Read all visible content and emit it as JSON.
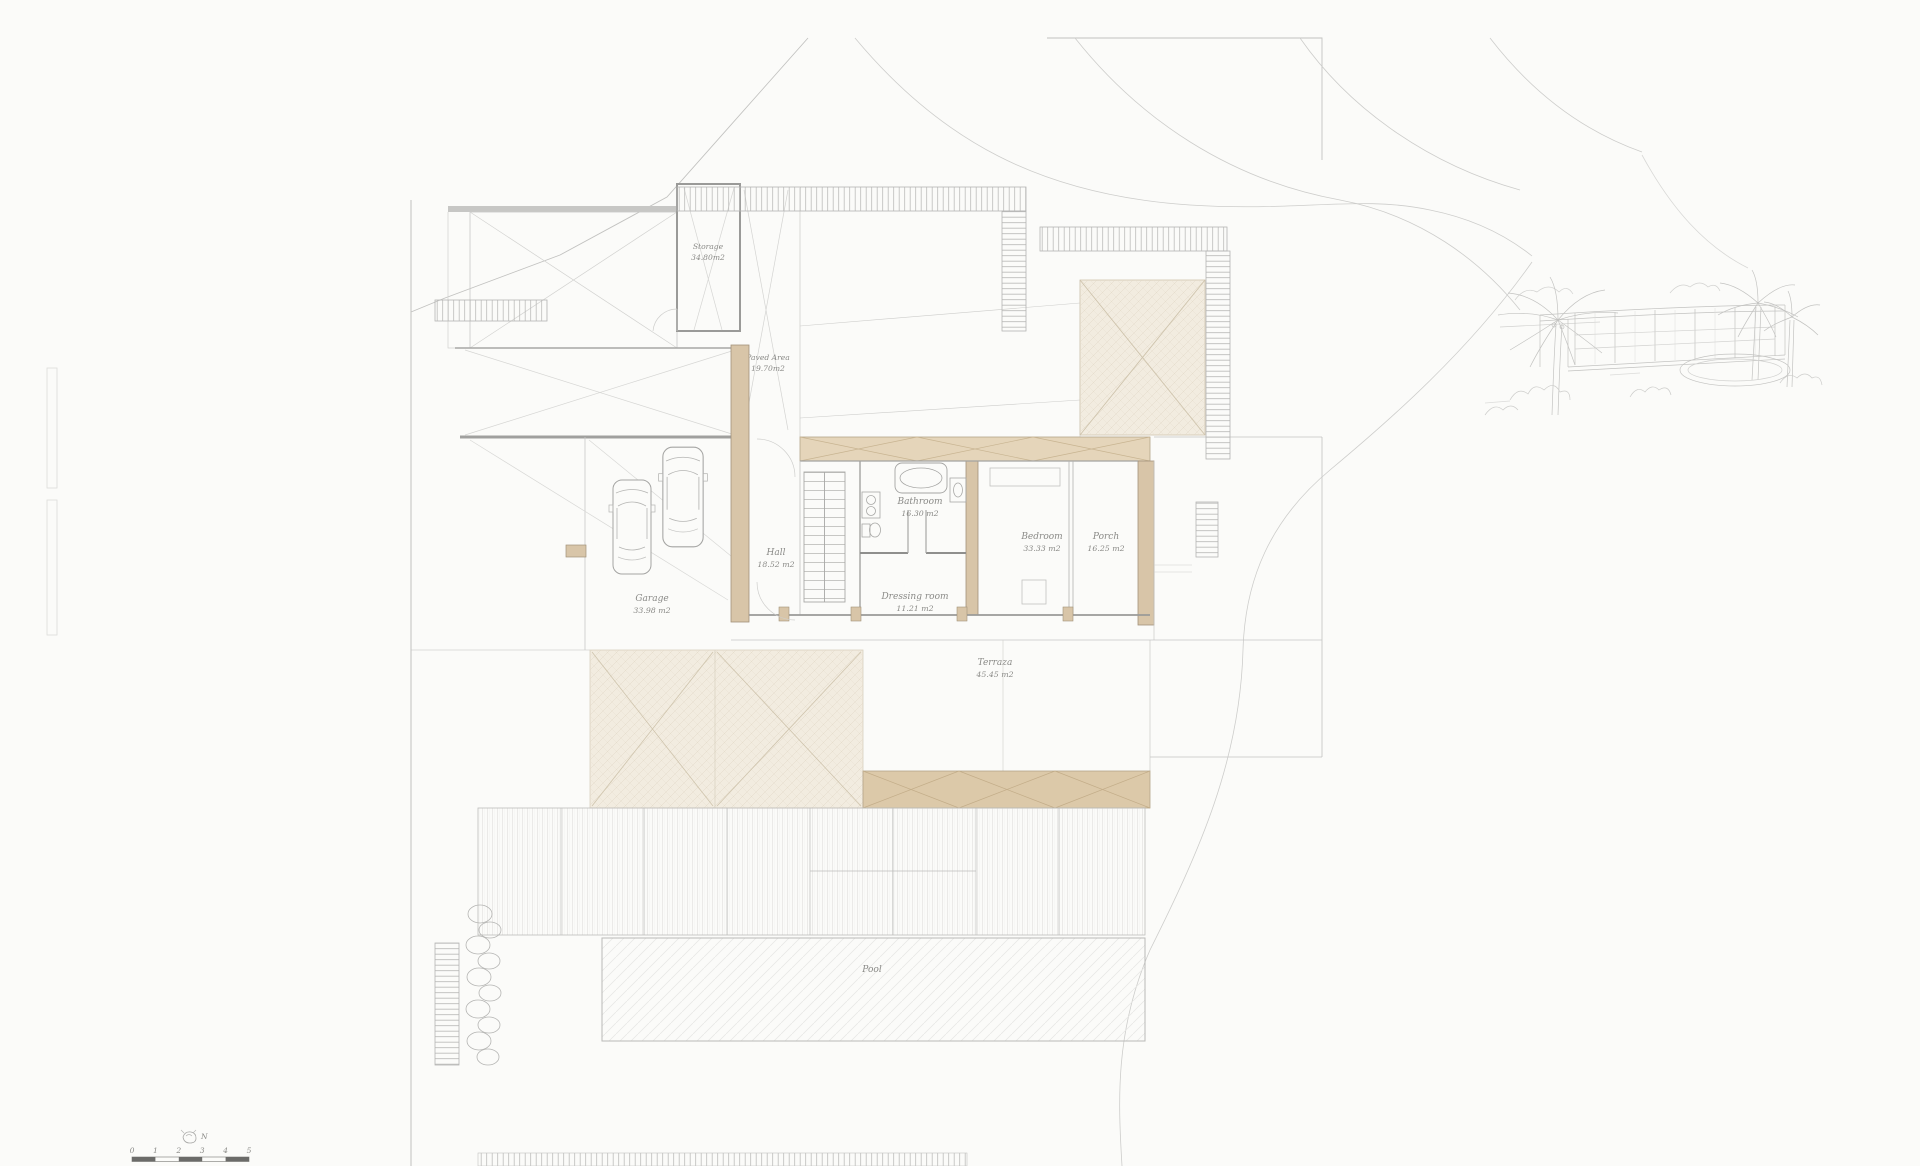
{
  "rooms": {
    "storage": {
      "name": "Storage",
      "area": "34.80m2"
    },
    "paved_area": {
      "name": "Paved Area",
      "area": "19.70m2"
    },
    "hall": {
      "name": "Hall",
      "area": "18.52 m2"
    },
    "bathroom": {
      "name": "Bathroom",
      "area": "16.30 m2"
    },
    "bedroom": {
      "name": "Bedroom",
      "area": "33.33 m2"
    },
    "porch": {
      "name": "Porch",
      "area": "16.25 m2"
    },
    "garage": {
      "name": "Garage",
      "area": "33.98 m2"
    },
    "dressing_room": {
      "name": "Dressing room",
      "area": "11.21 m2"
    },
    "terrace": {
      "name": "Terraza",
      "area": "45.45 m2"
    },
    "pool": {
      "name": "Pool"
    }
  },
  "scale_bar": {
    "ticks": [
      "0",
      "1",
      "2",
      "3",
      "4",
      "5"
    ]
  },
  "compass": {
    "label": "N"
  },
  "colors": {
    "paper": "#fbfbf9",
    "line_light": "#cfcfcd",
    "line_mid": "#a8a8a6",
    "line_dark": "#8f8f8d",
    "tan": "#d8c5a8",
    "tan_band": "#e5d5ba",
    "cream": "#f2ece0",
    "label_text": "#8a8a87"
  }
}
